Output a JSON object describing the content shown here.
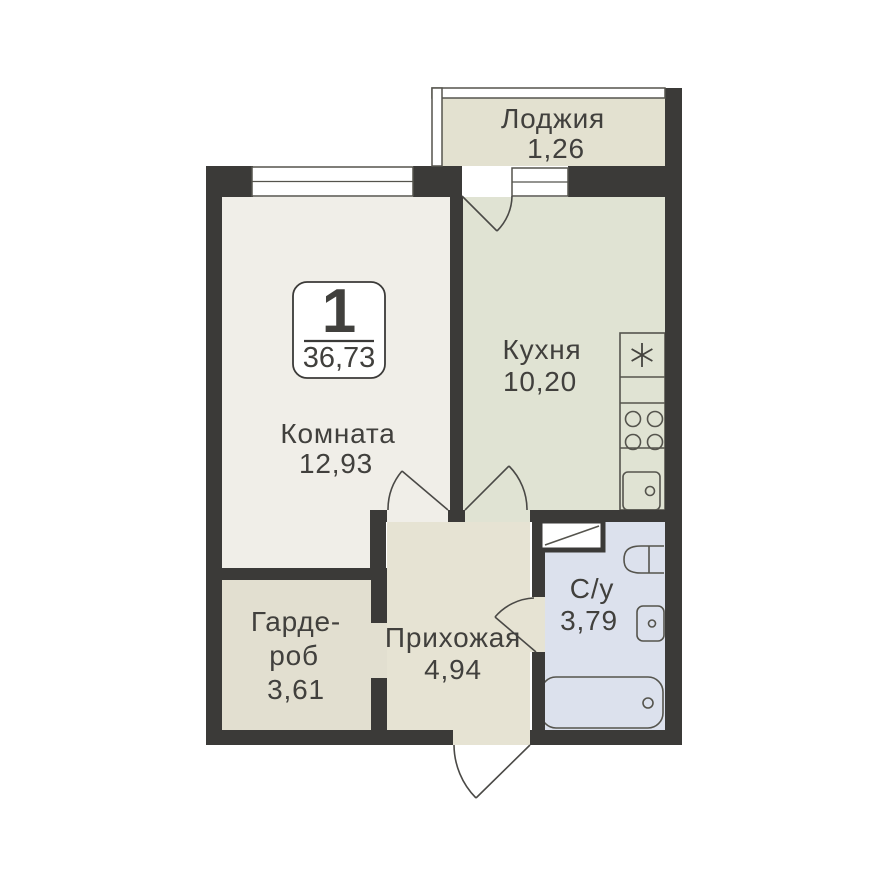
{
  "floor_plan": {
    "badge": {
      "room_count": "1",
      "total_area": "36,73"
    },
    "rooms": {
      "loggia": {
        "label": "Лоджия",
        "area": "1,26"
      },
      "kitchen": {
        "label": "Кухня",
        "area": "10,20"
      },
      "living": {
        "label": "Комната",
        "area": "12,93"
      },
      "wardrobe": {
        "label_line1": "Гарде-",
        "label_line2": "роб",
        "area": "3,61"
      },
      "hallway": {
        "label": "Прихожая",
        "area": "4,94"
      },
      "bathroom": {
        "label": "С/у",
        "area": "3,79"
      }
    },
    "fixtures": {
      "kitchen": [
        "fridge-freezer",
        "stove",
        "kitchen-sink"
      ],
      "bathroom": [
        "vent-shaft",
        "toilet",
        "wash-basin",
        "bathtub"
      ]
    },
    "colors": {
      "wall": "#3b3a38",
      "living_fill": "#f0eee8",
      "kitchen_fill": "#e0e3d3",
      "loggia_fill": "#e3e1d0",
      "hallway_fill": "#e6e3d3",
      "wardrobe_fill": "#e2dfd0",
      "bathroom_fill": "#dce1ed",
      "outline": "#55544d",
      "text": "#41403d"
    }
  }
}
